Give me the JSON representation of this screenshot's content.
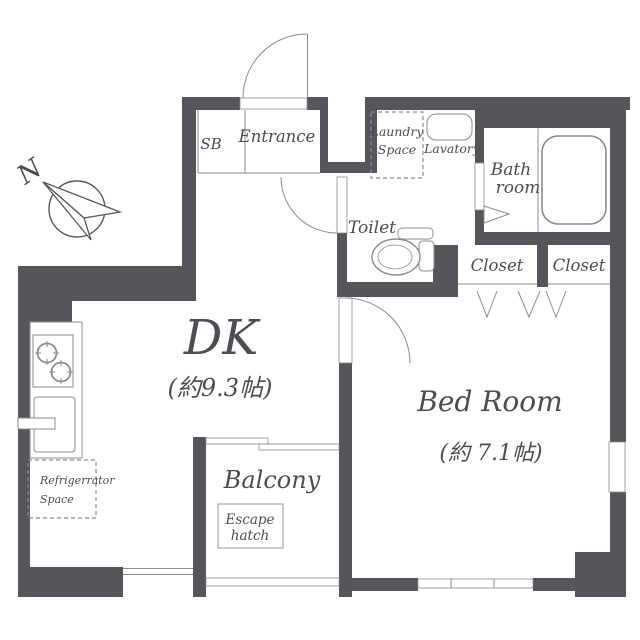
{
  "plan": {
    "title": "1DK apartment floor plan",
    "compass": {
      "north_label": "N"
    },
    "colors": {
      "wall": "#57555c",
      "line": "#87858d",
      "fixture": "#8c8a92",
      "text": "#4e4c55",
      "bg": "#ffffff"
    },
    "labels": {
      "sb": "SB",
      "entrance": "Entrance",
      "laundry_line1": "Laundry",
      "laundry_line2": "Space",
      "lavatory": "Lavatory",
      "bath_line1": "Bath",
      "bath_line2": "room",
      "toilet": "Toilet",
      "closet_left": "Closet",
      "closet_right": "Closet",
      "dk": "DK",
      "dk_size": "(約9.3帖)",
      "bedroom": "Bed Room",
      "bedroom_size": "(約 7.1帖)",
      "balcony": "Balcony",
      "escape_line1": "Escape",
      "escape_line2": "hatch",
      "fridge_line1": "Refrigerrator",
      "fridge_line2": "Space"
    }
  }
}
